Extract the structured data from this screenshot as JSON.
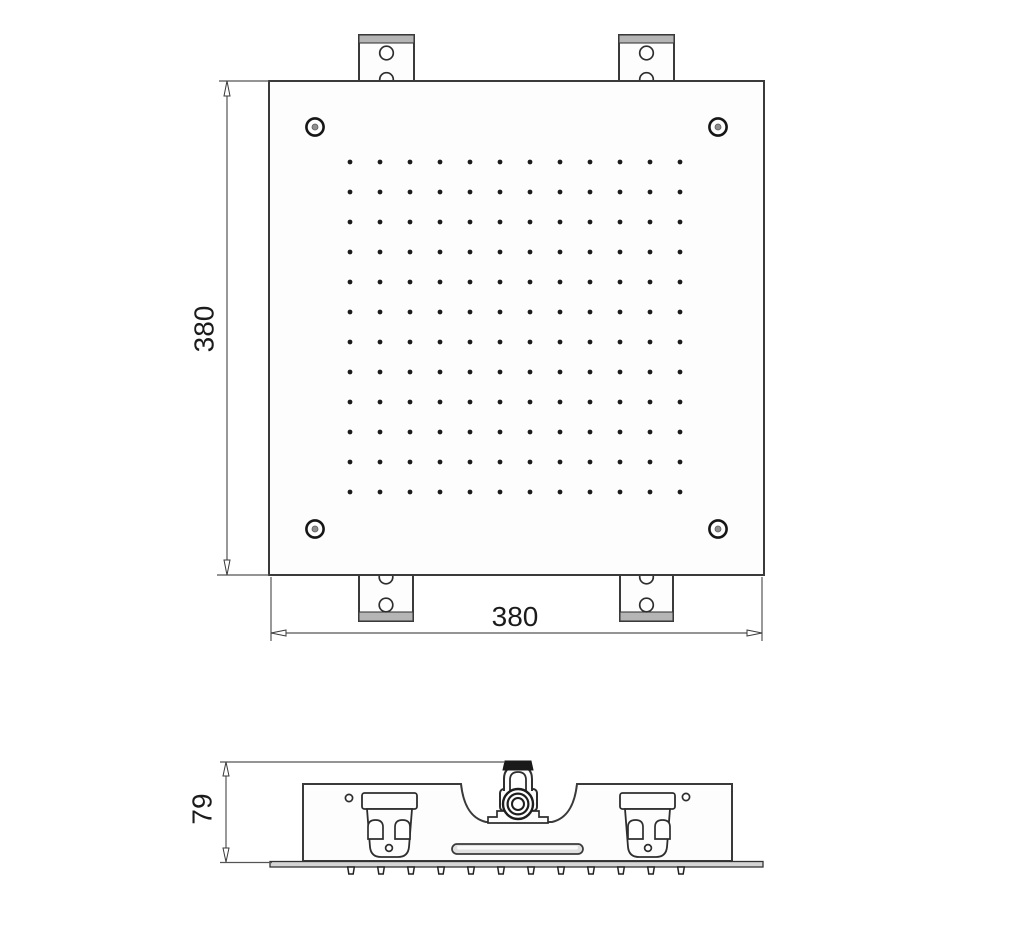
{
  "drawing": {
    "type": "technical-dimension-drawing",
    "views": [
      "top",
      "side"
    ],
    "dimensions": {
      "width_label": "380",
      "height_label": "380",
      "depth_label": "79"
    },
    "top_view": {
      "nozzle_grid": {
        "rows": 12,
        "cols": 12
      },
      "corner_screw_count": 4,
      "bracket_count": 4
    },
    "side_view": {
      "nozzle_count": 12,
      "bracket_count": 2,
      "has_center_inlet": true,
      "has_waterfall_slot": true
    },
    "colors": {
      "outline": "#3a3a3a",
      "dim_line": "#555555",
      "text": "#1b1b1b",
      "gray_band": "#b5b5b5",
      "dark_cap": "#1a1a1a",
      "dot": "#1c1c1c",
      "screw_center": "#8f8f8f",
      "background": "#ffffff"
    }
  }
}
